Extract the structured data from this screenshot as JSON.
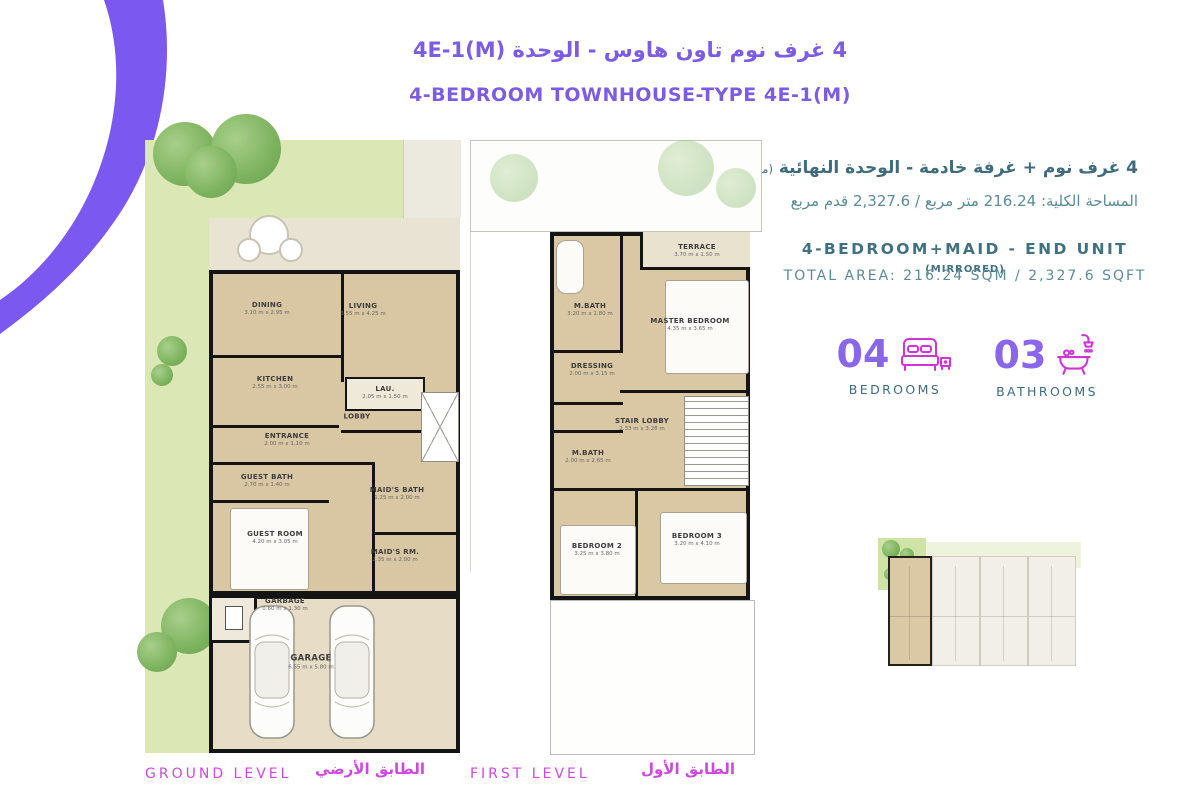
{
  "header": {
    "title_ar": "4 غرف نوم تاون هاوس - الوحدة 4E-1(M)",
    "title_en": "4-BEDROOM TOWNHOUSE-TYPE 4E-1(M)"
  },
  "unit_info": {
    "ar_line1": "4 غرف نوم + غرفة خادمة - الوحدة النهائية",
    "ar_line1_note": "(معكوسة)",
    "ar_line2": "المساحة الكلية: 216.24 متر مربع / 2,327.6 قدم مربع",
    "en_line1": "4-BEDROOM+MAID - END UNIT",
    "en_line1_note": "(MIRRORED)",
    "en_line2": "TOTAL AREA: 216.24 SQM / 2,327.6 SQFT"
  },
  "stats": {
    "bedrooms": {
      "count": "04",
      "label": "BEDROOMS",
      "icon": "bed-icon"
    },
    "bathrooms": {
      "count": "03",
      "label": "BATHROOMS",
      "icon": "bathtub-icon"
    }
  },
  "plans": {
    "ground": {
      "level_label_en": "GROUND LEVEL",
      "level_label_ar": "الطابق الأرضي",
      "rooms": [
        {
          "name": "DINING",
          "dims": "3.10 m x 2.95 m"
        },
        {
          "name": "LIVING",
          "dims": "3.55 m x 4.25 m"
        },
        {
          "name": "KITCHEN",
          "dims": "2.55 m x 3.00 m"
        },
        {
          "name": "LAU.",
          "dims": "2.05 m x 1.50 m"
        },
        {
          "name": "LOBBY",
          "dims": ""
        },
        {
          "name": "ENTRANCE",
          "dims": "2.00 m x 1.10 m"
        },
        {
          "name": "GUEST BATH",
          "dims": "2.70 m x 1.40 m"
        },
        {
          "name": "MAID'S BATH",
          "dims": "1.25 m x 2.00 m"
        },
        {
          "name": "GUEST ROOM",
          "dims": "4.20 m x 3.05 m"
        },
        {
          "name": "MAID'S RM.",
          "dims": "2.35 m x 2.00 m"
        },
        {
          "name": "GARBAGE",
          "dims": "0.60 m x 1.30 m"
        },
        {
          "name": "GARAGE",
          "dims": "6.55 m x 5.80 m"
        }
      ]
    },
    "first": {
      "level_label_en": "FIRST LEVEL",
      "level_label_ar": "الطابق الأول",
      "rooms": [
        {
          "name": "TERRACE",
          "dims": "3.70 m x 1.50 m"
        },
        {
          "name": "M.BATH",
          "dims": "3.20 m x 1.80 m"
        },
        {
          "name": "MASTER BEDROOM",
          "dims": "4.35 m x 3.65 m"
        },
        {
          "name": "DRESSING",
          "dims": "2.00 m x 3.15 m"
        },
        {
          "name": "STAIR LOBBY",
          "dims": "2.33 m x 3.28 m"
        },
        {
          "name": "M.BATH",
          "dims": "2.00 m x 2.65 m"
        },
        {
          "name": "BEDROOM 2",
          "dims": "3.25 m x 3.80 m"
        },
        {
          "name": "BEDROOM 3",
          "dims": "3.20 m x 4.10 m"
        }
      ]
    }
  },
  "colors": {
    "accent_purple": "#7b58ef",
    "title_purple": "#7b5ce2",
    "stat_number_purple": "#8a67ea",
    "icon_magenta": "#cf35d5",
    "level_label_magenta": "#cb4add",
    "info_teal_dark": "#3f6b7a",
    "info_teal_light": "#5d8a97",
    "plan_floor_beige": "#d9c7a3",
    "garden_green": "#dbe7b4",
    "wall_black": "#141414"
  }
}
